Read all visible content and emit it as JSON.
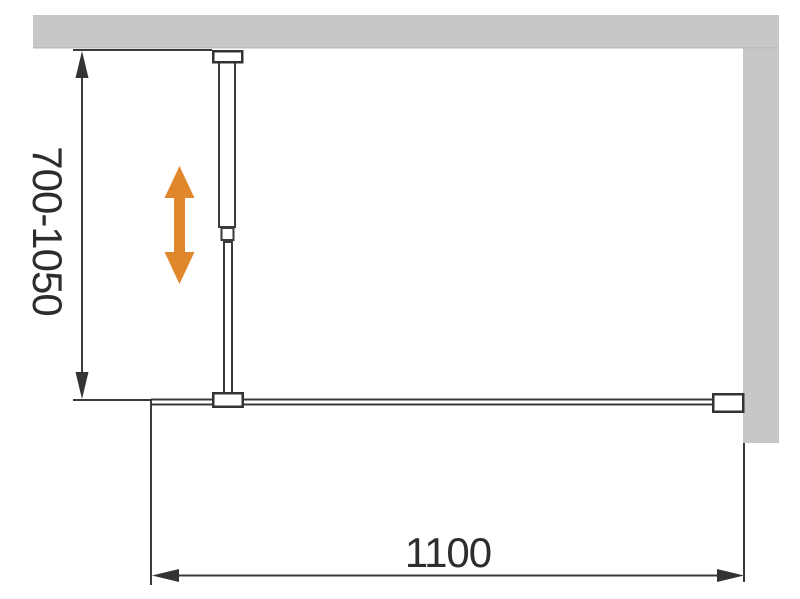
{
  "diagram": {
    "kind": "technical installation drawing",
    "vertical_dimension": {
      "label": "700-1050"
    },
    "horizontal_dimension": {
      "label": "1100"
    },
    "colors": {
      "wall": "#c7c7c7",
      "wall_edge": "#bcbcbc",
      "line": "#3a3a3a",
      "text": "#2d2d2d",
      "accent_arrow": "#e0872c",
      "background": "#ffffff"
    },
    "icons": {
      "adjustability_arrow": "double-headed-vertical-arrow"
    }
  }
}
